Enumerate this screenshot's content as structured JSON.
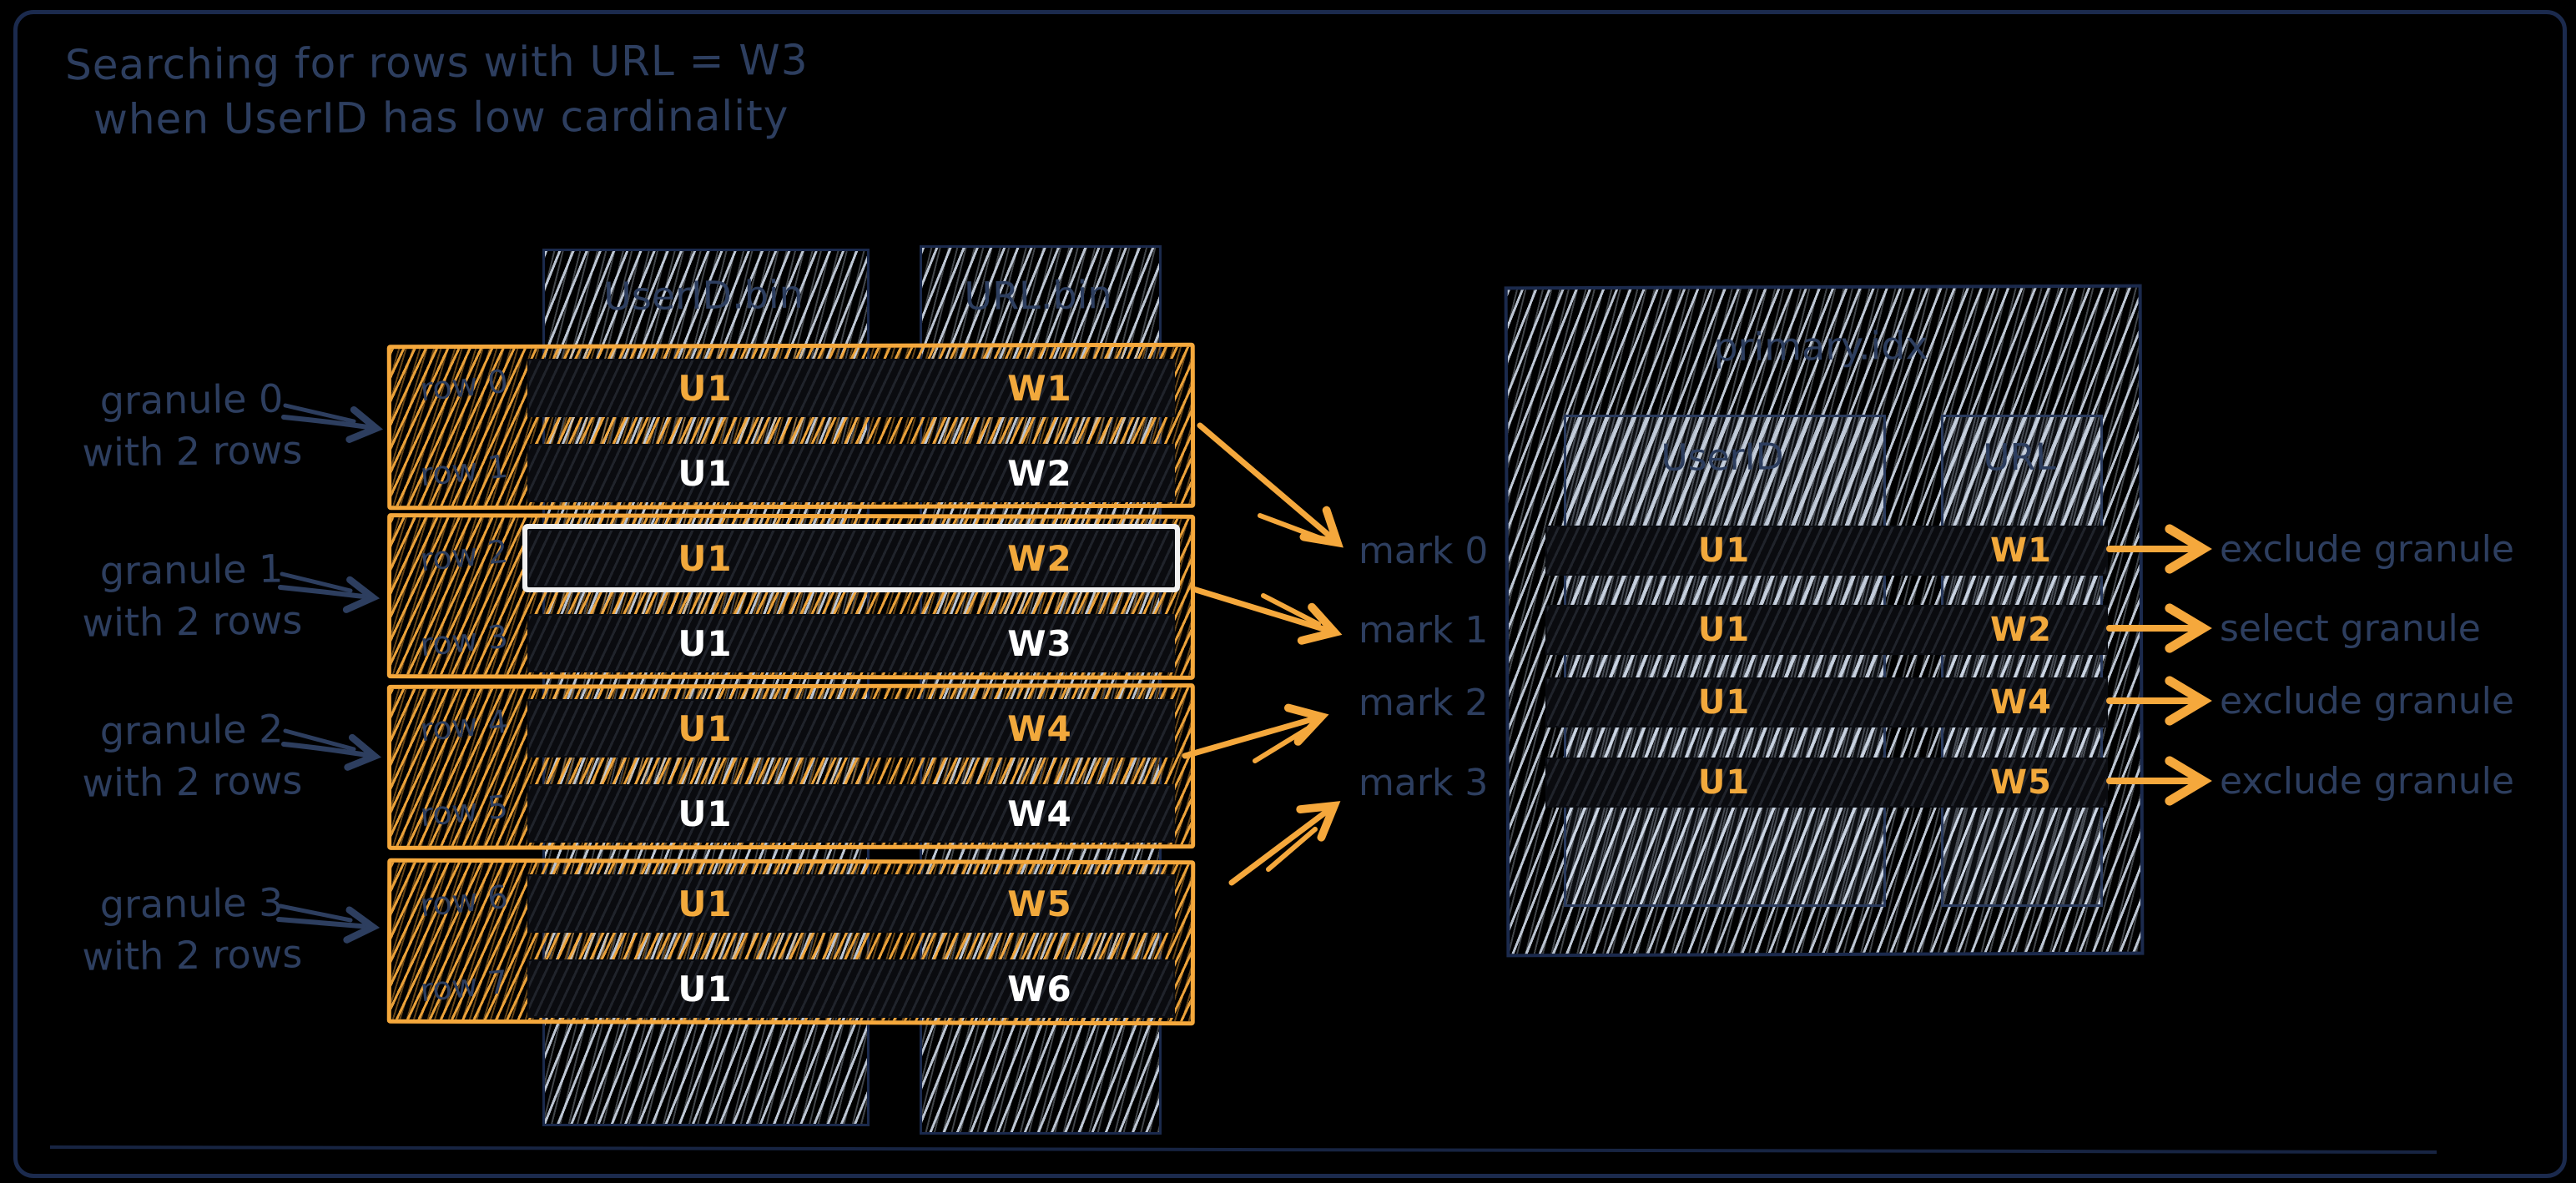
{
  "title": {
    "line1": "Searching for rows with URL = W3",
    "line2": "when UserID has low cardinality"
  },
  "left_panel": {
    "columns": [
      {
        "label": "UserID.bin"
      },
      {
        "label": "URL.bin"
      }
    ],
    "granules": [
      {
        "label1": "granule 0",
        "label2": "with 2 rows",
        "rows": [
          {
            "name": "row 0",
            "userid": "U1",
            "url": "W1"
          },
          {
            "name": "row 1",
            "userid": "U1",
            "url": "W2"
          }
        ]
      },
      {
        "label1": "granule 1",
        "label2": "with 2 rows",
        "rows": [
          {
            "name": "row 2",
            "userid": "U1",
            "url": "W2"
          },
          {
            "name": "row 3",
            "userid": "U1",
            "url": "W3"
          }
        ]
      },
      {
        "label1": "granule 2",
        "label2": "with 2 rows",
        "rows": [
          {
            "name": "row 4",
            "userid": "U1",
            "url": "W4"
          },
          {
            "name": "row 5",
            "userid": "U1",
            "url": "W4"
          }
        ]
      },
      {
        "label1": "granule 3",
        "label2": "with 2 rows",
        "rows": [
          {
            "name": "row 6",
            "userid": "U1",
            "url": "W5"
          },
          {
            "name": "row 7",
            "userid": "U1",
            "url": "W6"
          }
        ]
      }
    ]
  },
  "marks": [
    {
      "label": "mark 0"
    },
    {
      "label": "mark 1"
    },
    {
      "label": "mark 2"
    },
    {
      "label": "mark 3"
    }
  ],
  "index_panel": {
    "title": "primary.idx",
    "columns": [
      {
        "label": "UserID"
      },
      {
        "label": "URL"
      }
    ],
    "rows": [
      {
        "userid": "U1",
        "url": "W1",
        "action": "exclude granule"
      },
      {
        "userid": "U1",
        "url": "W2",
        "action": "select granule"
      },
      {
        "userid": "U1",
        "url": "W4",
        "action": "exclude granule"
      },
      {
        "userid": "U1",
        "url": "W5",
        "action": "exclude granule"
      }
    ]
  },
  "colors": {
    "background": "#000000",
    "navy": "#2D3E5F",
    "border_navy": "#1B2A4D",
    "orange": "#F2A93C",
    "orange_hatch": "#F5A83C",
    "light_hatch": "#CED8E6",
    "white": "#FFFFFF",
    "highlight_border": "#F1F1F1"
  }
}
